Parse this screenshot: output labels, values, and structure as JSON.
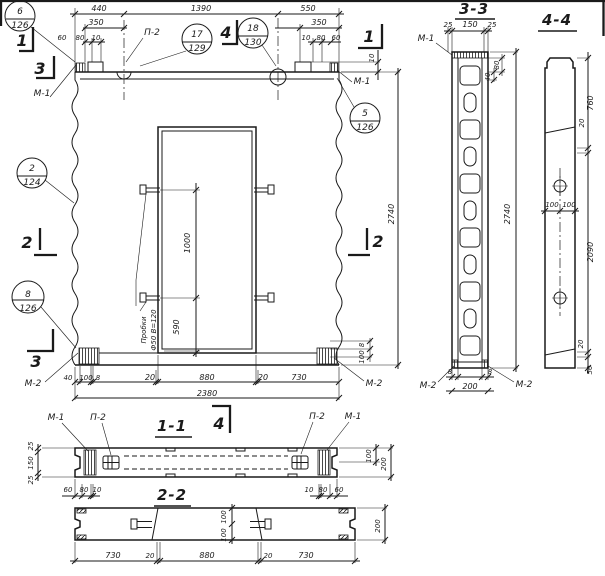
{
  "colors": {
    "ink": "#1a1a1a",
    "paper": "#ffffff"
  },
  "main_view": {
    "top_dims": {
      "d440": "440",
      "d1390": "1390",
      "d550": "550",
      "d350_left": "350",
      "d350_right": "350",
      "d60_l": "60",
      "d80_l": "80",
      "d10_l": "10",
      "d10_r": "10",
      "d80_r": "80",
      "d60_r": "60",
      "d10_corner": "10"
    },
    "side_dims": {
      "d2740": "2740"
    },
    "opening_dims": {
      "d1000": "1000",
      "d590": "590",
      "note_line1": "Пробки",
      "note_line2": "Ф50 В=120"
    },
    "bottom_dims": {
      "d40": "40",
      "d100": "100",
      "d8": "8",
      "d20_l": "20",
      "d880": "880",
      "d20_r": "20",
      "d730": "730",
      "d2380": "2380",
      "d8_v": "8",
      "d100_v": "100"
    },
    "labels": {
      "p2": "П-2",
      "m1_tl": "М-1",
      "m1_tr": "М-1",
      "m2_bl": "М-2",
      "m2_br": "М-2"
    },
    "marks": {
      "s1_l": "1",
      "s1_r": "1",
      "s2_l": "2",
      "s2_r": "2",
      "s3_t": "3",
      "s3_b": "3",
      "s4_t": "4"
    },
    "callouts": {
      "c6": {
        "num": "6",
        "sheet": "126"
      },
      "c17": {
        "num": "17",
        "sheet": "129"
      },
      "c18": {
        "num": "18",
        "sheet": "130"
      },
      "c5": {
        "num": "5",
        "sheet": "126"
      },
      "c2": {
        "num": "2",
        "sheet": "124"
      },
      "c8": {
        "num": "8",
        "sheet": "126"
      }
    }
  },
  "section_3_3": {
    "title": "3-3",
    "dims": {
      "d25_l": "25",
      "d150": "150",
      "d25_r": "25",
      "d80": "80",
      "d40": "40",
      "d2740": "2740",
      "d8_l": "8",
      "d8_r": "8",
      "d200": "200"
    },
    "labels": {
      "m1": "М-1",
      "m2_l": "М-2",
      "m2_r": "М-2"
    }
  },
  "section_4_4": {
    "title": "4-4",
    "dims": {
      "d760": "760",
      "d20_t": "20",
      "d2090": "2090",
      "d100_l": "100",
      "d100_r": "100",
      "d20_b": "20",
      "d50": "50"
    }
  },
  "section_1_1": {
    "title": "1-1",
    "mark": "4",
    "dims": {
      "d25_t": "25",
      "d150": "150",
      "d25_b": "25",
      "d60_l": "60",
      "d80_l": "80",
      "d10_l": "10",
      "d10_r": "10",
      "d80_r": "80",
      "d60_r": "60",
      "d100": "100",
      "d200": "200"
    },
    "labels": {
      "m1_l": "М-1",
      "p2_l": "П-2",
      "p2_r": "П-2",
      "m1_r": "М-1"
    }
  },
  "section_2_2": {
    "title": "2-2",
    "dims": {
      "d730_l": "730",
      "d20_l": "20",
      "d880": "880",
      "d20_r": "20",
      "d730_r": "730",
      "d100_t": "100",
      "d100_b": "100",
      "d200": "200"
    }
  }
}
